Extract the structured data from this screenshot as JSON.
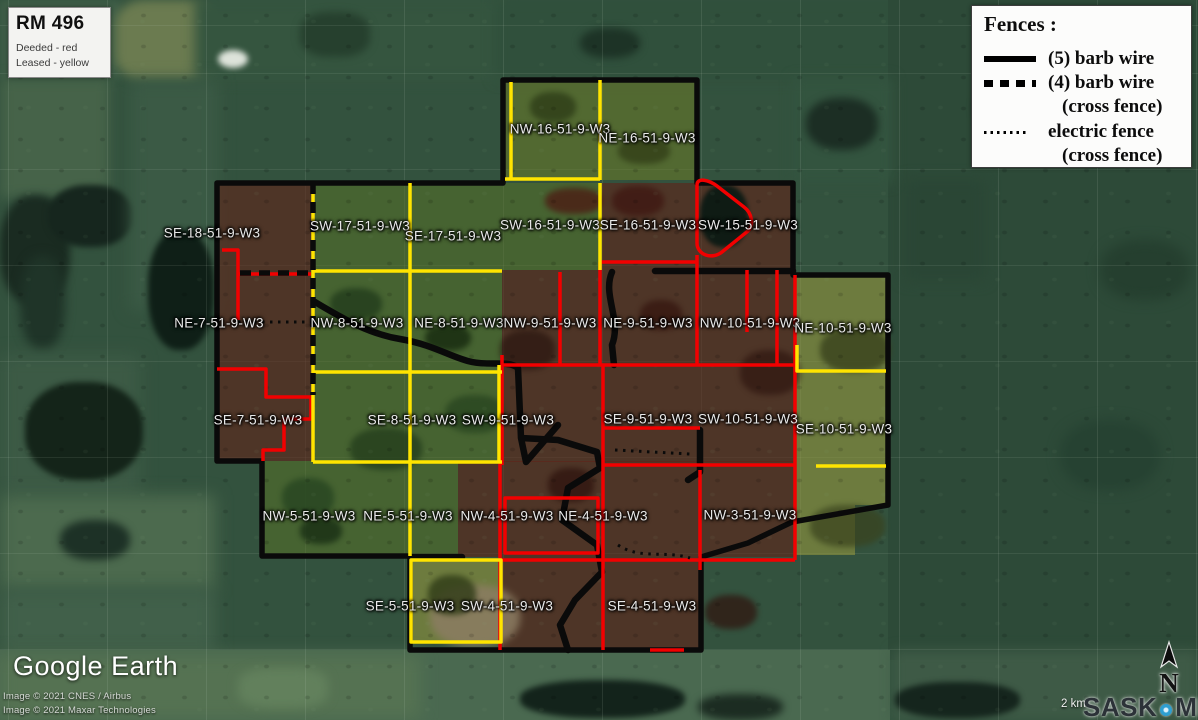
{
  "map": {
    "rm_box": {
      "title": "RM 496",
      "line1": "Deeded - red",
      "line2": "Leased - yellow"
    },
    "fences_legend": {
      "title": "Fences :",
      "items": [
        {
          "sample": "solid",
          "label": "(5) barb wire"
        },
        {
          "sample": "dashed",
          "label": "(4) barb wire",
          "label2": "(cross fence)"
        },
        {
          "sample": "dotted",
          "label": "electric  fence",
          "label2": "(cross fence)"
        }
      ]
    },
    "colors": {
      "deeded": "#ff0000",
      "leased": "#ffe400",
      "fence": "#0a0a0a"
    },
    "sections": [
      {
        "label": "NW-16-51-9-W3",
        "x": 560,
        "y": 129
      },
      {
        "label": "NE-16-51-9-W3",
        "x": 647,
        "y": 138
      },
      {
        "label": "SE-18-51-9-W3",
        "x": 212,
        "y": 233
      },
      {
        "label": "SW-17-51-9-W3",
        "x": 360,
        "y": 226
      },
      {
        "label": "SE-17-51-9-W3",
        "x": 453,
        "y": 236
      },
      {
        "label": "SW-16-51-9-W3",
        "x": 550,
        "y": 225
      },
      {
        "label": "SE-16-51-9-W3",
        "x": 648,
        "y": 225
      },
      {
        "label": "SW-15-51-9-W3",
        "x": 748,
        "y": 225
      },
      {
        "label": "NE-7-51-9-W3",
        "x": 219,
        "y": 323
      },
      {
        "label": "NW-8-51-9-W3",
        "x": 357,
        "y": 323
      },
      {
        "label": "NE-8-51-9-W3",
        "x": 459,
        "y": 323
      },
      {
        "label": "NW-9-51-9-W3",
        "x": 550,
        "y": 323
      },
      {
        "label": "NE-9-51-9-W3",
        "x": 648,
        "y": 323
      },
      {
        "label": "NW-10-51-9-W3",
        "x": 750,
        "y": 323
      },
      {
        "label": "NE-10-51-9-W3",
        "x": 843,
        "y": 328
      },
      {
        "label": "SE-7-51-9-W3",
        "x": 258,
        "y": 420
      },
      {
        "label": "SE-8-51-9-W3",
        "x": 412,
        "y": 420
      },
      {
        "label": "SW-9-51-9-W3",
        "x": 508,
        "y": 420
      },
      {
        "label": "SE-9-51-9-W3",
        "x": 648,
        "y": 419
      },
      {
        "label": "SW-10-51-9-W3",
        "x": 748,
        "y": 419
      },
      {
        "label": "SE-10-51-9-W3",
        "x": 844,
        "y": 429
      },
      {
        "label": "NW-5-51-9-W3",
        "x": 309,
        "y": 516
      },
      {
        "label": "NE-5-51-9-W3",
        "x": 408,
        "y": 516
      },
      {
        "label": "NW-4-51-9-W3",
        "x": 507,
        "y": 516
      },
      {
        "label": "NE-4-51-9-W3",
        "x": 603,
        "y": 516
      },
      {
        "label": "NW-3-51-9-W3",
        "x": 750,
        "y": 515
      },
      {
        "label": "SE-5-51-9-W3",
        "x": 410,
        "y": 606
      },
      {
        "label": "SW-4-51-9-W3",
        "x": 507,
        "y": 606
      },
      {
        "label": "SE-4-51-9-W3",
        "x": 652,
        "y": 606
      }
    ]
  },
  "google_earth": {
    "logo": "Google Earth",
    "attribution_line1": "Image © 2021 CNES / Airbus",
    "attribution_line2": "Image © 2021 Maxar Technologies"
  },
  "scale_label": "2 km",
  "compass_label": "N",
  "watermark": {
    "text1": "SASK",
    "text2": "MLS",
    "registered": "®"
  }
}
